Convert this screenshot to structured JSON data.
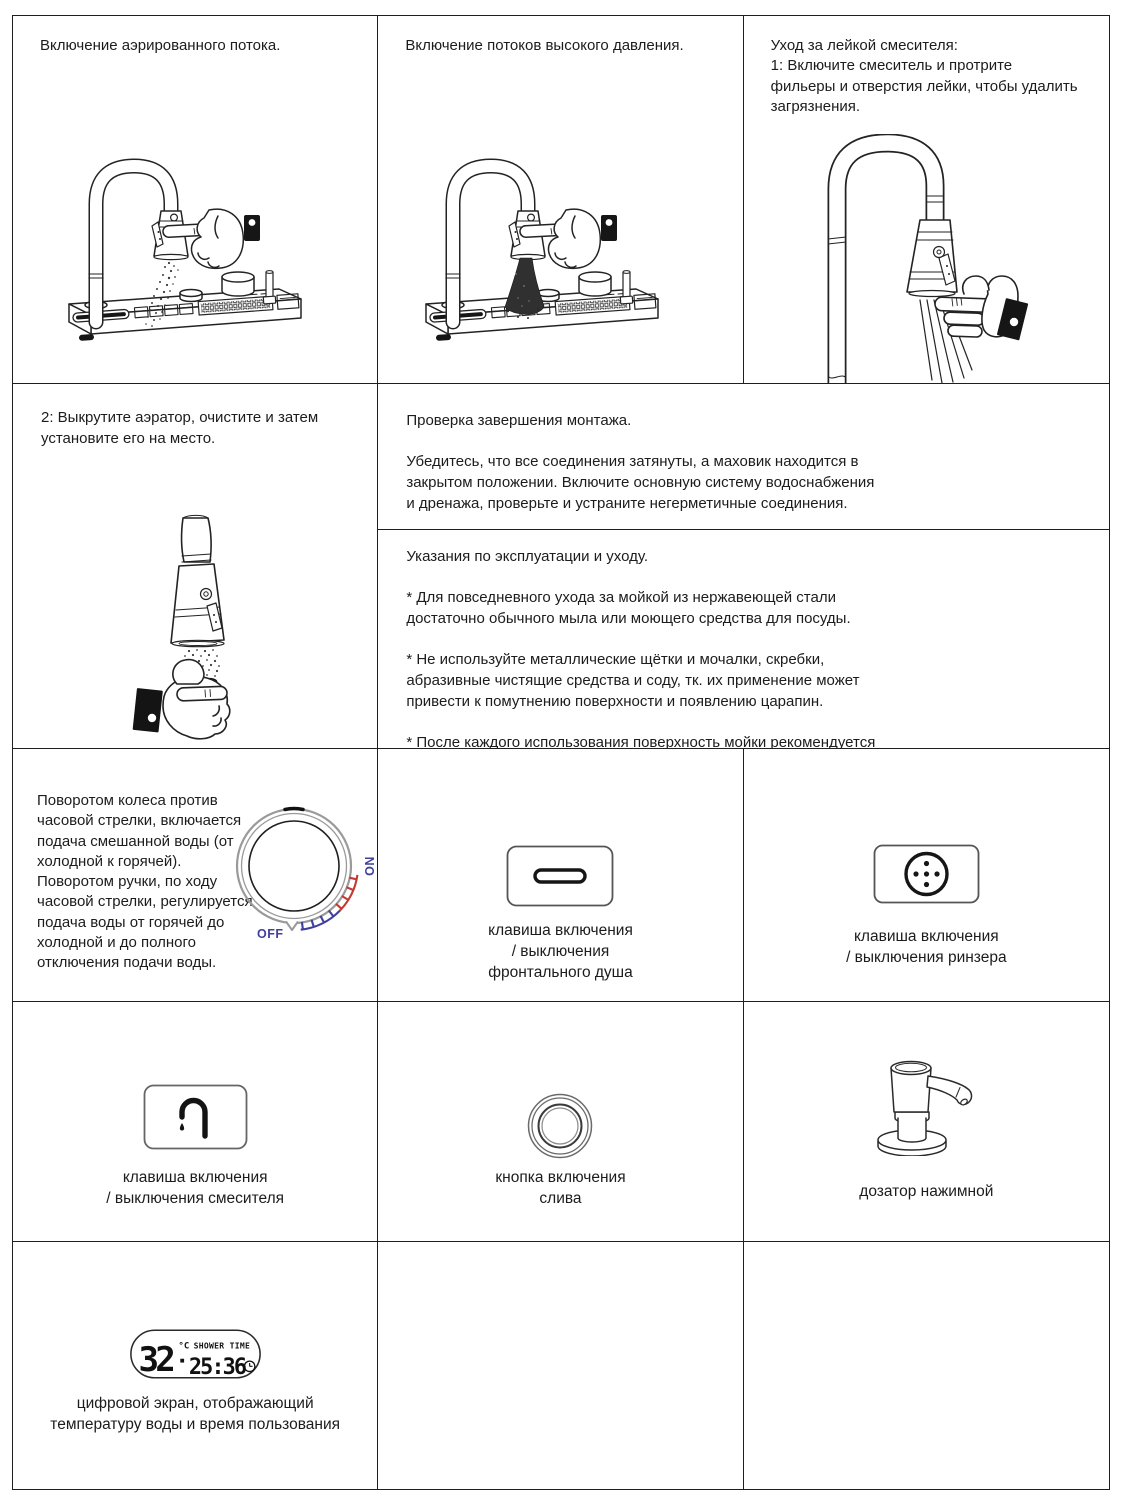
{
  "cells": {
    "aerated_flow": {
      "title": "Включение аэрированного потока."
    },
    "high_pressure": {
      "title": "Включение потоков высокого давления."
    },
    "spray_care": {
      "title": "Уход за лейкой смесителя:\n1: Включите смеситель и протрите\nфильеры и отверстия лейки, чтобы удалить\nзагрязнения."
    },
    "aerator_step2": {
      "text": "2: Выкрутите аэратор, очистите и затем\nустановите его на место."
    },
    "installation_check": {
      "text": "Проверка завершения монтажа.\n\nУбедитесь, что все соединения затянуты, а маховик находится в\nзакрытом положении. Включите основную систему водоснабжения\nи дренажа, проверьте и устраните негерметичные соединения."
    },
    "care_instructions": {
      "text": "Указания по эксплуатации и уходу.\n\n* Для повседневного ухода за мойкой из нержавеющей стали\nдостаточно обычного мыла или моющего средства для посуды.\n\n* Не используйте металлические щётки и мочалки, скребки,\nабразивные чистящие средства и соду, тк. их применение может\nпривести к помутнению поверхности и появлению царапин.\n\n* После каждого использования поверхность мойки рекомендуется\nпромыть водой и вытереть пористой тканью или салфеткой."
    },
    "dial": {
      "text": "Поворотом колеса против\nчасовой стрелки, включается\nподача смешанной воды (от\nхолодной к горячей).\nПоворотом ручки, по ходу\nчасовой стрелки, регулируется\nподача воды от горячей до\nхолодной и до полного\nотключения подачи воды.",
      "on_label": "ON",
      "off_label": "OFF",
      "on_color": "#3f3f9e",
      "hot_arc_color": "#c23a32",
      "cold_arc_color": "#3f3f9e"
    },
    "front_shower_key": {
      "caption": "клавиша включения\n/ выключения\nфронтального душа"
    },
    "rinser_key": {
      "caption": "клавиша включения\n/ выключения ринзера"
    },
    "mixer_key": {
      "caption": "клавиша включения\n/ выключения смесителя"
    },
    "drain_button": {
      "caption": "кнопка включения\nслива"
    },
    "soap_dispenser": {
      "caption": "дозатор нажимной"
    },
    "digital_screen": {
      "caption": "цифровой экран, отображающий\nтемпературу воды и время пользования",
      "temperature": "32",
      "temp_unit": "°C",
      "label": "SHOWER TIME",
      "time": "25:36"
    }
  }
}
